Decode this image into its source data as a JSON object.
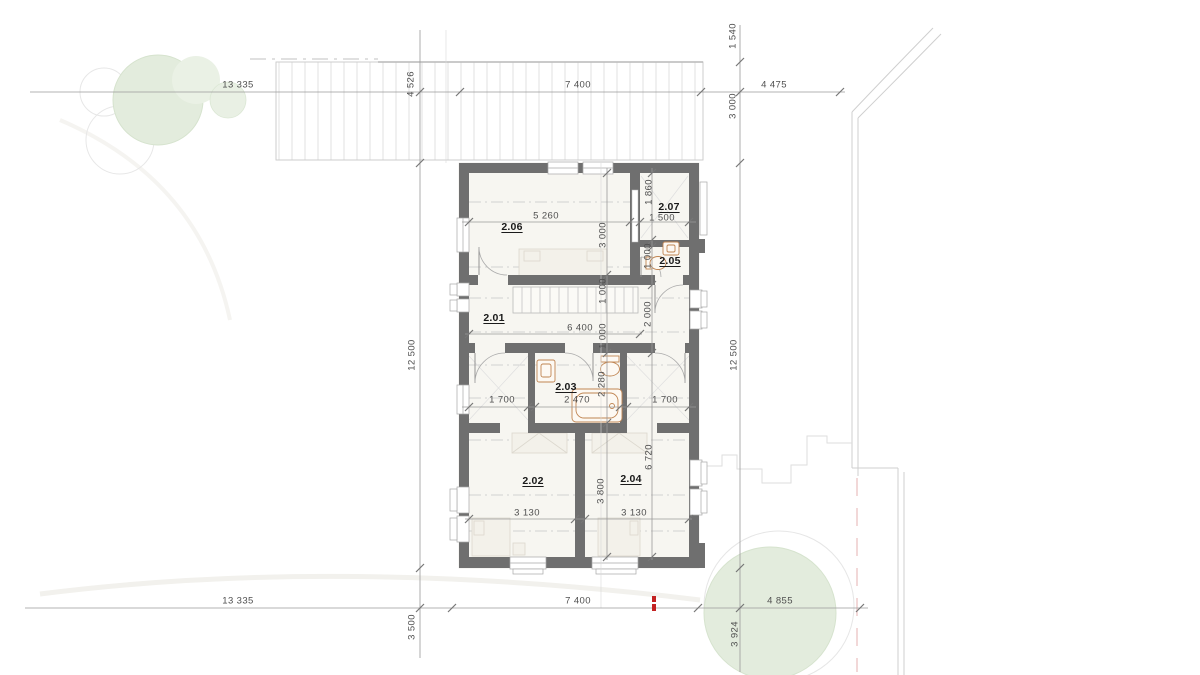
{
  "colors": {
    "wall": "#6f6f6f",
    "floor": "#f7f6f1",
    "fixture_outline": "#c08552",
    "tree_fill": "#e3ecdd",
    "dimension_text": "#4f4f4f",
    "room_label_text": "#1a1a1a",
    "survey_marker_red": "#c32222"
  },
  "plan": {
    "rooms": [
      {
        "label": "2.01",
        "x": 494,
        "y": 318
      },
      {
        "label": "2.02",
        "x": 533,
        "y": 481
      },
      {
        "label": "2.03",
        "x": 566,
        "y": 387
      },
      {
        "label": "2.04",
        "x": 631,
        "y": 479
      },
      {
        "label": "2.05",
        "x": 670,
        "y": 261
      },
      {
        "label": "2.06",
        "x": 512,
        "y": 227
      },
      {
        "label": "2.07",
        "x": 669,
        "y": 207
      }
    ],
    "dimensions": [
      {
        "text": "13 335",
        "x": 238,
        "y": 85,
        "vertical": false
      },
      {
        "text": "7 400",
        "x": 578,
        "y": 85,
        "vertical": false
      },
      {
        "text": "4 475",
        "x": 774,
        "y": 85,
        "vertical": false
      },
      {
        "text": "4 526",
        "x": 411,
        "y": 84,
        "vertical": true
      },
      {
        "text": "1 540",
        "x": 733,
        "y": 36,
        "vertical": true
      },
      {
        "text": "3 000",
        "x": 733,
        "y": 106,
        "vertical": true
      },
      {
        "text": "12 500",
        "x": 412,
        "y": 355,
        "vertical": true
      },
      {
        "text": "12 500",
        "x": 734,
        "y": 355,
        "vertical": true
      },
      {
        "text": "5 260",
        "x": 546,
        "y": 216,
        "vertical": false
      },
      {
        "text": "3 000",
        "x": 603,
        "y": 235,
        "vertical": true
      },
      {
        "text": "1 860",
        "x": 649,
        "y": 192,
        "vertical": true
      },
      {
        "text": "1 500",
        "x": 662,
        "y": 218,
        "vertical": false
      },
      {
        "text": "1 000",
        "x": 648,
        "y": 256,
        "vertical": true
      },
      {
        "text": "1 000",
        "x": 603,
        "y": 291,
        "vertical": true
      },
      {
        "text": "1 000",
        "x": 603,
        "y": 336,
        "vertical": true
      },
      {
        "text": "2 000",
        "x": 648,
        "y": 314,
        "vertical": true
      },
      {
        "text": "6 400",
        "x": 580,
        "y": 328,
        "vertical": false
      },
      {
        "text": "1 700",
        "x": 502,
        "y": 400,
        "vertical": false
      },
      {
        "text": "2 470",
        "x": 577,
        "y": 400,
        "vertical": false
      },
      {
        "text": "1 700",
        "x": 665,
        "y": 400,
        "vertical": false
      },
      {
        "text": "2 280",
        "x": 602,
        "y": 384,
        "vertical": true
      },
      {
        "text": "3 800",
        "x": 601,
        "y": 491,
        "vertical": true
      },
      {
        "text": "6 720",
        "x": 649,
        "y": 457,
        "vertical": true
      },
      {
        "text": "3 130",
        "x": 527,
        "y": 513,
        "vertical": false
      },
      {
        "text": "3 130",
        "x": 634,
        "y": 513,
        "vertical": false
      },
      {
        "text": "13 335",
        "x": 238,
        "y": 601,
        "vertical": false
      },
      {
        "text": "7 400",
        "x": 578,
        "y": 601,
        "vertical": false
      },
      {
        "text": "4 855",
        "x": 780,
        "y": 601,
        "vertical": false
      },
      {
        "text": "3 500",
        "x": 412,
        "y": 627,
        "vertical": true
      },
      {
        "text": "3 924",
        "x": 735,
        "y": 634,
        "vertical": true
      }
    ]
  }
}
